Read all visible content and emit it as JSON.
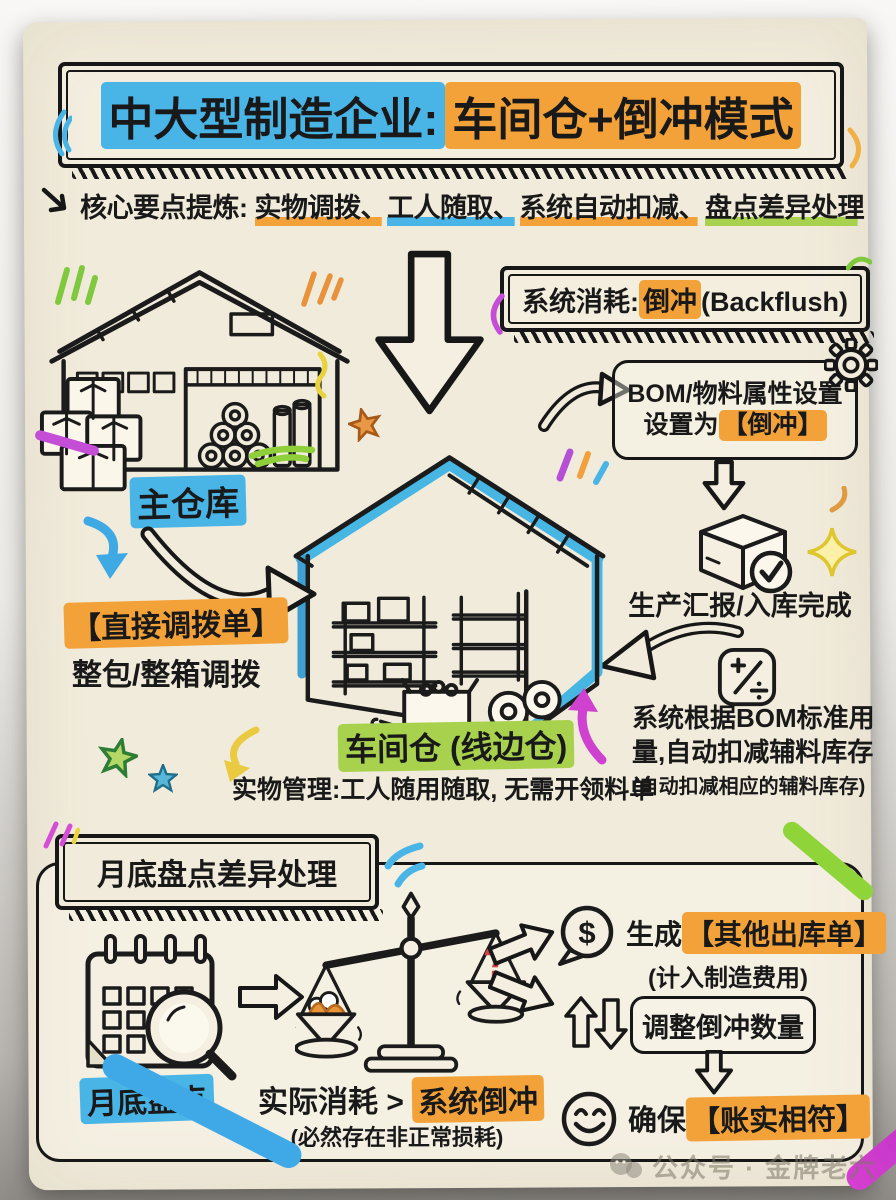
{
  "accents": {
    "blue": "#49b4e6",
    "orange": "#f2a238",
    "green": "#a8d14e",
    "red": "#d94343",
    "magenta": "#ce42cf",
    "yellow": "#e9ca41",
    "ink": "#171717",
    "paper": "#f1ebdb"
  },
  "title": {
    "part_blue": "中大型制造企业:",
    "part_orange": "车间仓+倒冲模式"
  },
  "subtitle": {
    "label": "核心要点提炼:",
    "p1": "实物调拨、",
    "p2": "工人随取、",
    "p3": "系统自动扣减、",
    "p4": "盘点差异处理"
  },
  "flow": {
    "main_warehouse_label": "主仓库",
    "transfer_tag": "【直接调拨单】",
    "transfer_desc": "整包/整箱调拨",
    "sc_prefix": "系统消耗:",
    "sc_hl": "倒冲",
    "sc_suffix": "(Backflush)",
    "bom_line1": "BOM/物料属性设置",
    "bom_l2_prefix": "设置为",
    "bom_l2_hl": "【倒冲】",
    "production_report": "生产汇报/入库完成",
    "ded_l1": "系统根据BOM标准用",
    "ded_l2": "量,自动扣减辅料库存",
    "ded_note": "(自动扣减相应的辅料库存)",
    "workshop_label": "车间仓 (线边仓)",
    "workshop_desc": "实物管理:工人随用随取, 无需开领料单"
  },
  "bottom": {
    "header": "月底盘点差异处理",
    "inventory_label": "月底盘点",
    "cmp_prefix": "实际消耗 > ",
    "cmp_hl": "系统倒冲",
    "cmp_note": "(必然存在非正常损耗)",
    "q": "?",
    "dollar": "$",
    "out_prefix": "生成",
    "out_hl": "【其他出库单】",
    "out_note": "(计入制造费用)",
    "adjust": "调整倒冲数量",
    "ensure_prefix": "确保",
    "ensure_hl": "【账实相符】"
  },
  "watermark": {
    "text": "公众号 · 金牌老六"
  }
}
